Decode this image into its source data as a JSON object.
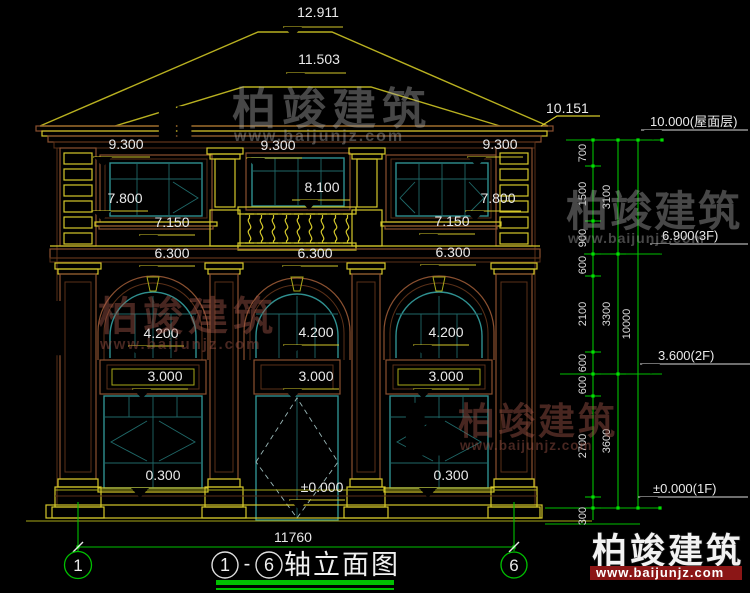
{
  "watermark": {
    "brand": "柏竣建筑",
    "url": "www.baijunjz.com"
  },
  "title": {
    "axis_start": "1",
    "separator": "-",
    "axis_end": "6",
    "name": "轴立面图"
  },
  "axis_bubbles": {
    "left": "1",
    "right": "6"
  },
  "bottom_dimension": "11760",
  "building_markers": {
    "ridge": "12.911",
    "front_ridge": "11.503",
    "right_eave": "10.151",
    "eave_left": "9.300",
    "eave_center": "9.300",
    "eave_right": "9.300",
    "balcony_head": "8.100",
    "window_head_left": "7.800",
    "window_head_right": "7.800",
    "window_sill_left": "7.150",
    "window_sill_right": "7.150",
    "floor2_left": "6.300",
    "floor2_center": "6.300",
    "floor2_right": "6.300",
    "arch_left": "4.200",
    "arch_center": "4.200",
    "arch_right": "4.200",
    "transom_left": "3.000",
    "transom_center": "3.000",
    "transom_right": "3.000",
    "sill_left": "0.300",
    "sill_right": "0.300",
    "entry_level": "±0.000"
  },
  "right_dimensions": {
    "levels": [
      {
        "label": "10.000(屋面层)"
      },
      {
        "label": "6.900(3F)"
      },
      {
        "label": "3.600(2F)"
      },
      {
        "label": "±0.000(1F)"
      }
    ],
    "chain_inner": [
      "700",
      "1500",
      "900",
      "600",
      "2100",
      "600",
      "600",
      "2700",
      "300"
    ],
    "chain_middle": [
      "3100",
      "3300",
      "3600"
    ],
    "chain_outer": [
      "10000"
    ]
  },
  "colors": {
    "dimension_green": "#00c000",
    "trim_yellow": "#d4c82a",
    "wall_brown": "#8a5030",
    "window_teal": "#2f9090",
    "logo_blue": "#1a56b0",
    "logo_orange": "#f59a23",
    "url_band_red": "#8b1616"
  }
}
